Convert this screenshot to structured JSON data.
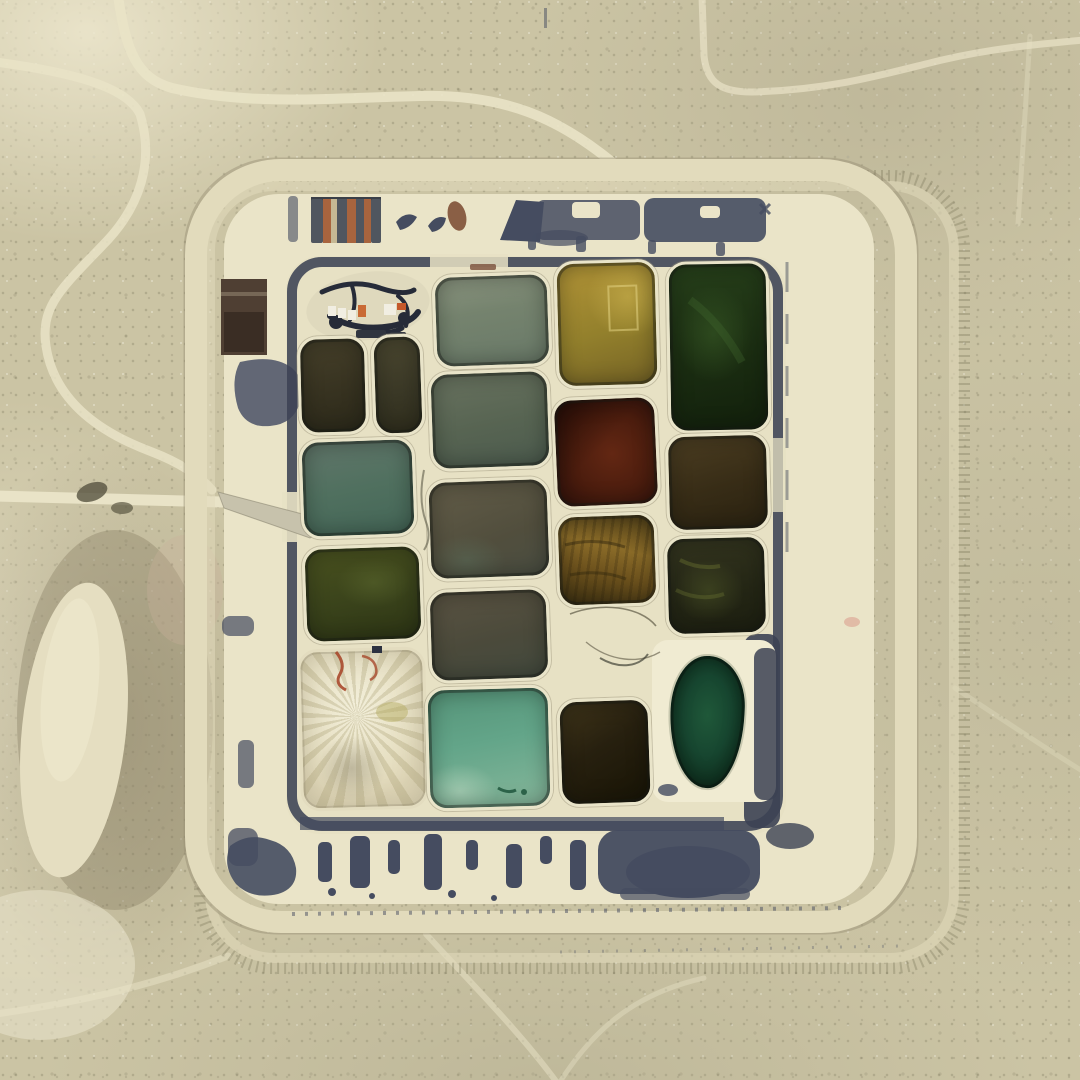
{
  "scene": {
    "description": "Aerial satellite photograph of a square bermed evaporation-pond facility in flat tan desert, containing a staggered 4-column grid of rectangular ponds in greens, olives, ambers, maroon and turquoise, surrounded by graded ring roads, dark tire/stain smears along the inner berm, a small equipment yard with trucks in the upper-left of the compound, and faint desert tracks outside.",
    "setting": "desert scrubland, top-down view",
    "facility": "evaporation pond grid with perimeter berm roads",
    "water_pond_count": 17,
    "dry_cell_count": 2,
    "grid_columns": 4
  },
  "palette": {
    "desert": "#cbc4a4",
    "desert-light": "#e5dfc2",
    "desert-dark": "#a89f82",
    "compound": "#eae4c8",
    "floor": "#e7e1c4",
    "berm": "#3c4254",
    "stain": "#454c60",
    "road": "#e9e3c7",
    "ring": "#e2dbbc",
    "ramp": "#c7c2ac",
    "mound": "#e5dec1",
    "brown-pad": "#4f3f33",
    "kidney-pad": "#f0ebd2",
    "tank-slate": "#50565f",
    "tank-rust": "#a8643e",
    "tank-tan": "#c5b894",
    "truck-white": "#f1eee2",
    "truck-orange": "#c96a35",
    "squiggle-red": "#a8492c",
    "crack": "#6f6a55",
    "pink-dot": "#dfb4a0",
    "equip-dark": "#262b38"
  },
  "ponds": {
    "pair-left-olive": {
      "name": "pond-pair-left-olive",
      "color": "#3b3522",
      "fill": "linear-gradient(168deg,#46402a 0%,#332f1e 70%,#2b291a 100%)"
    },
    "pair-right-olive": {
      "name": "pond-pair-right-olive",
      "color": "#413e29",
      "fill": "linear-gradient(172deg,#4b4730 0%,#3a3826 60%,#2f2d1c 100%)"
    },
    "sage": {
      "name": "pond-sage-green",
      "color": "#75826e",
      "fill": "linear-gradient(172deg,#8a947f 0%,#75836e 40%,#697968 100%)"
    },
    "yellow": {
      "name": "pond-yellow-olive",
      "color": "#9c8530",
      "fill": "radial-gradient(70% 55% at 72% 28%, rgba(205,180,80,.55), transparent 60%), linear-gradient(165deg,#a98e34 15%,#93802c 55%,#756325 100%)"
    },
    "darkgreen": {
      "name": "pond-dark-green",
      "color": "#1d3013",
      "fill": "radial-gradient(60% 45% at 45% 42%, rgba(66,105,44,.42), transparent 65%), linear-gradient(170deg,#263f1a 0%,#1a2c11 60%,#12200c 100%)"
    },
    "graygreen": {
      "name": "pond-gray-green",
      "color": "#5b6755",
      "fill": "linear-gradient(170deg,#68725f 0%,#576452 55%,#4c5b4e 100%)"
    },
    "maroon": {
      "name": "pond-maroon",
      "color": "#4e1f0f",
      "fill": "linear-gradient(135deg, rgba(25,8,4,.5), transparent 45%), radial-gradient(72% 68% at 56% 52%, #632713 0%, #4c1d0e 55%, #33110a 100%)"
    },
    "umber": {
      "name": "pond-umber-brown",
      "color": "#3a2f18",
      "fill": "linear-gradient(165deg,#4c3e22 0%,#372c16 55%,#2a2211 100%)"
    },
    "teal": {
      "name": "pond-teal-gray",
      "color": "#53705f",
      "fill": "linear-gradient(170deg,#61766a 0%,#50705f 50%,#446657 100%)"
    },
    "taupe": {
      "name": "pond-taupe",
      "color": "#55523f",
      "fill": "radial-gradient(55% 45% at 30% 82%, rgba(95,125,105,.35), transparent 60%), linear-gradient(160deg,#625c48 0%,#514e3d 60%,#4a4e42 100%)"
    },
    "amber": {
      "name": "pond-amber",
      "color": "#6e541e",
      "fill": "repeating-linear-gradient(100deg, rgba(40,30,10,.22) 0 3px, transparent 3px 9px), linear-gradient(15deg,#3a2e10 0%,#6d521d 38%,#8a6b28 62%,#66501e 85%,#4a3a16 100%)"
    },
    "blackolive": {
      "name": "pond-black-olive",
      "color": "#2a2b18",
      "fill": "radial-gradient(60% 55% at 42% 55%, rgba(96,108,46,.35), transparent 60%), linear-gradient(170deg,#34351f 0%,#242615 60%,#1c1e10 100%)"
    },
    "olivegreen": {
      "name": "pond-olive-green",
      "color": "#3e481d",
      "fill": "radial-gradient(55% 45% at 60% 38%, rgba(105,120,55,.35), transparent 60%), linear-gradient(170deg,#49511f 0%,#3a431b 55%,#2c3414 100%)"
    },
    "graybrown": {
      "name": "pond-gray-brown",
      "color": "#4e4a3a",
      "fill": "linear-gradient(168deg,#5a5342 0%,#4b4a3b 55%,#434a3e 100%)"
    },
    "turquoise": {
      "name": "pond-turquoise",
      "color": "#64a488",
      "fill": "radial-gradient(50% 38% at 25% 86%, rgba(195,222,198,.5), transparent 62%), linear-gradient(170deg,#559378 0%,#63a589 45%,#79b094 80%,#88b89d 100%)"
    },
    "darkbrown": {
      "name": "pond-dark-brown",
      "color": "#26200f",
      "fill": "linear-gradient(150deg,#40351a 0%,#27200f 45%,#181405 100%)"
    },
    "kidney-green": {
      "name": "pond-kidney-dark-green",
      "color": "#143726",
      "fill": "radial-gradient(60% 55% at 50% 45%, #1f5839 0%, #174630 55%, #0e2e1d 100%)"
    },
    "dry-white": {
      "name": "pond-dry-white",
      "color": "#e9e2c6",
      "fill": "radial-gradient(40% 30% at 40% 75%, rgba(150,143,120,.5), transparent 70%), repeating-conic-gradient(from 200deg at 45% 42%, rgba(165,155,110,.30) 0deg 6deg, rgba(0,0,0,0) 6deg 14deg), radial-gradient(70% 60% at 45% 35%, #f2eed9 0%, #e7e0c3 70%, #ded5b6 100%)"
    }
  }
}
